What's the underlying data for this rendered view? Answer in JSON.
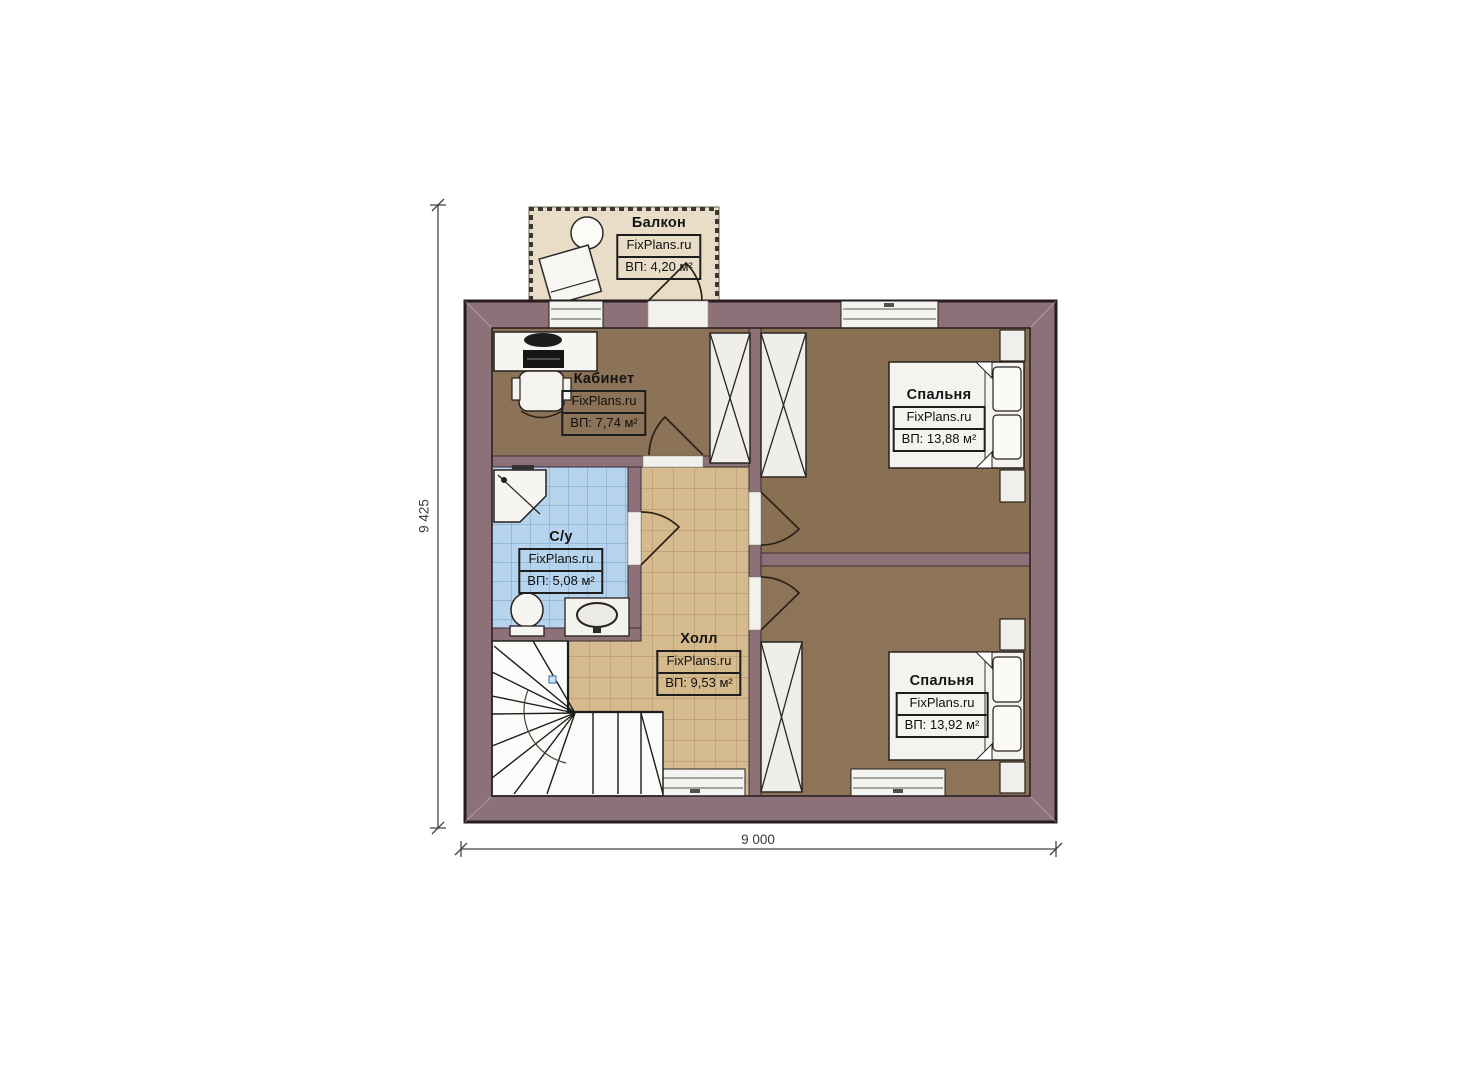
{
  "plan": {
    "brand": "FixPlans.ru",
    "dimensions": {
      "height_label": "9 425",
      "width_label": "9 000"
    },
    "rooms": [
      {
        "key": "balcony",
        "title": "Балкон",
        "brand": "FixPlans.ru",
        "area": "ВП: 4,20 м²"
      },
      {
        "key": "office",
        "title": "Кабинет",
        "brand": "FixPlans.ru",
        "area": "ВП: 7,74 м²"
      },
      {
        "key": "bedroom_top",
        "title": "Спальня",
        "brand": "FixPlans.ru",
        "area": "ВП: 13,88 м²"
      },
      {
        "key": "bathroom",
        "title": "С/у",
        "brand": "FixPlans.ru",
        "area": "ВП: 5,08 м²"
      },
      {
        "key": "hall",
        "title": "Холл",
        "brand": "FixPlans.ru",
        "area": "ВП: 9,53 м²"
      },
      {
        "key": "bedroom_bottom",
        "title": "Спальня",
        "brand": "FixPlans.ru",
        "area": "ВП: 13,92 м²"
      }
    ],
    "colors": {
      "wall": "#8c7179",
      "wood_floor": "#8c7256",
      "hall_tile": "#d5ba8e",
      "bath_tile": "#b7d4ee",
      "balcony_floor": "#e9ddc7"
    }
  }
}
